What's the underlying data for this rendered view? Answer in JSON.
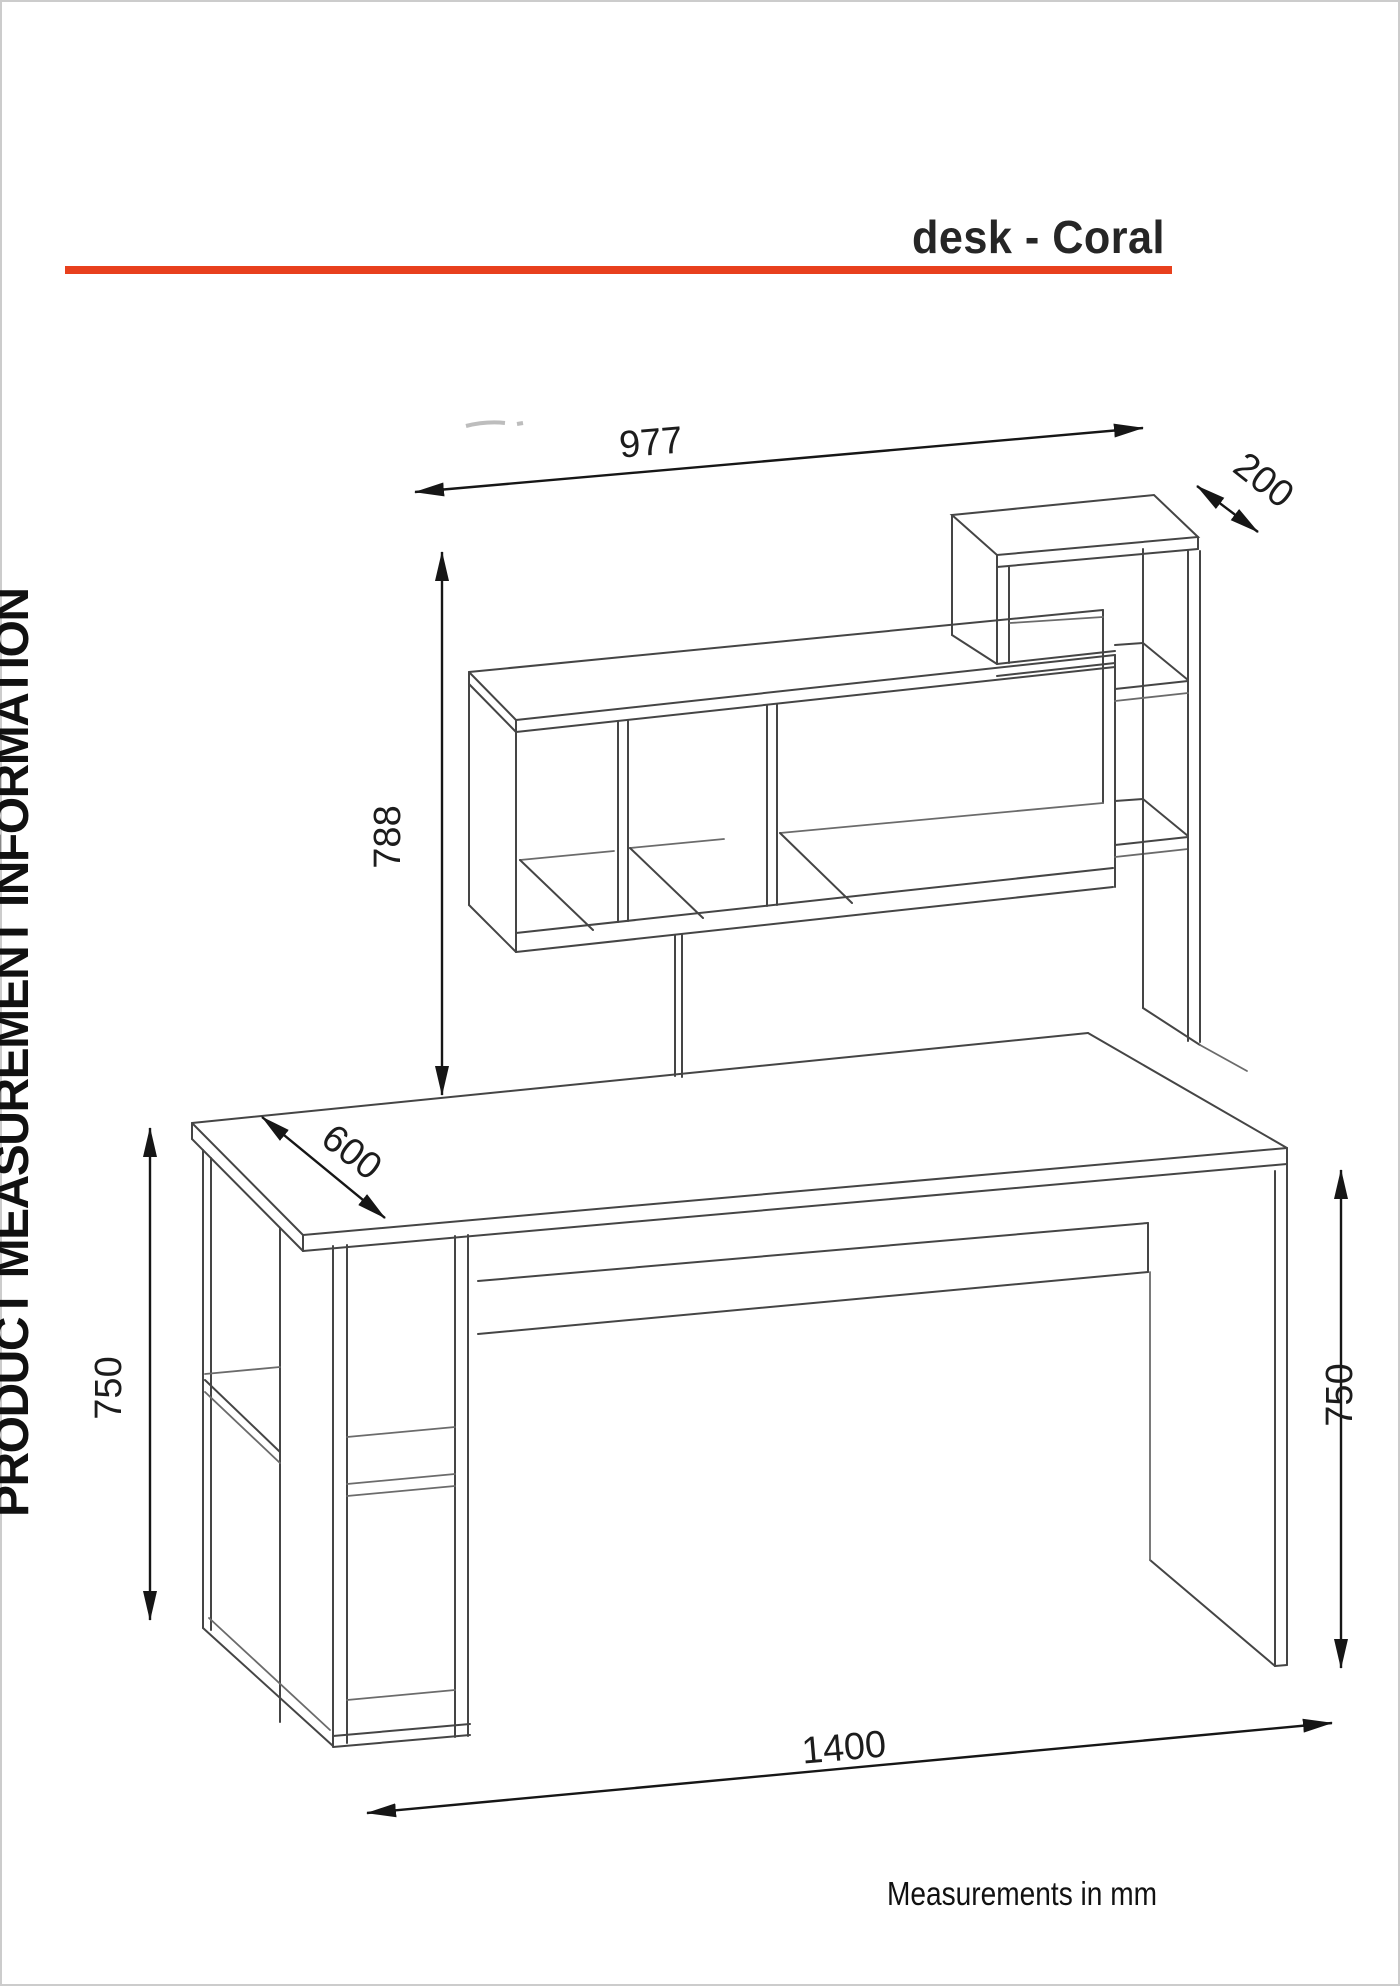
{
  "page": {
    "width": 1400,
    "height": 1986,
    "background": "#ffffff",
    "border_color": "#cccccc"
  },
  "header": {
    "title": "desk - Coral",
    "accent_color": "#e8401d",
    "text_color": "#262626"
  },
  "sidebar": {
    "label": "PRODUCT MEASUREMENT INFORMATION"
  },
  "footer": {
    "note": "Measurements in mm"
  },
  "drawing": {
    "subject": "desk with hutch shelving unit",
    "style": "isometric line drawing",
    "line_color": "#454545",
    "dimension_line_color": "#161616"
  },
  "dimensions": {
    "unit": "mm",
    "hutch_width": "977",
    "hutch_depth": "200",
    "hutch_height": "788",
    "desktop_depth": "600",
    "height_left": "750",
    "height_right": "750",
    "desk_width": "1400"
  }
}
